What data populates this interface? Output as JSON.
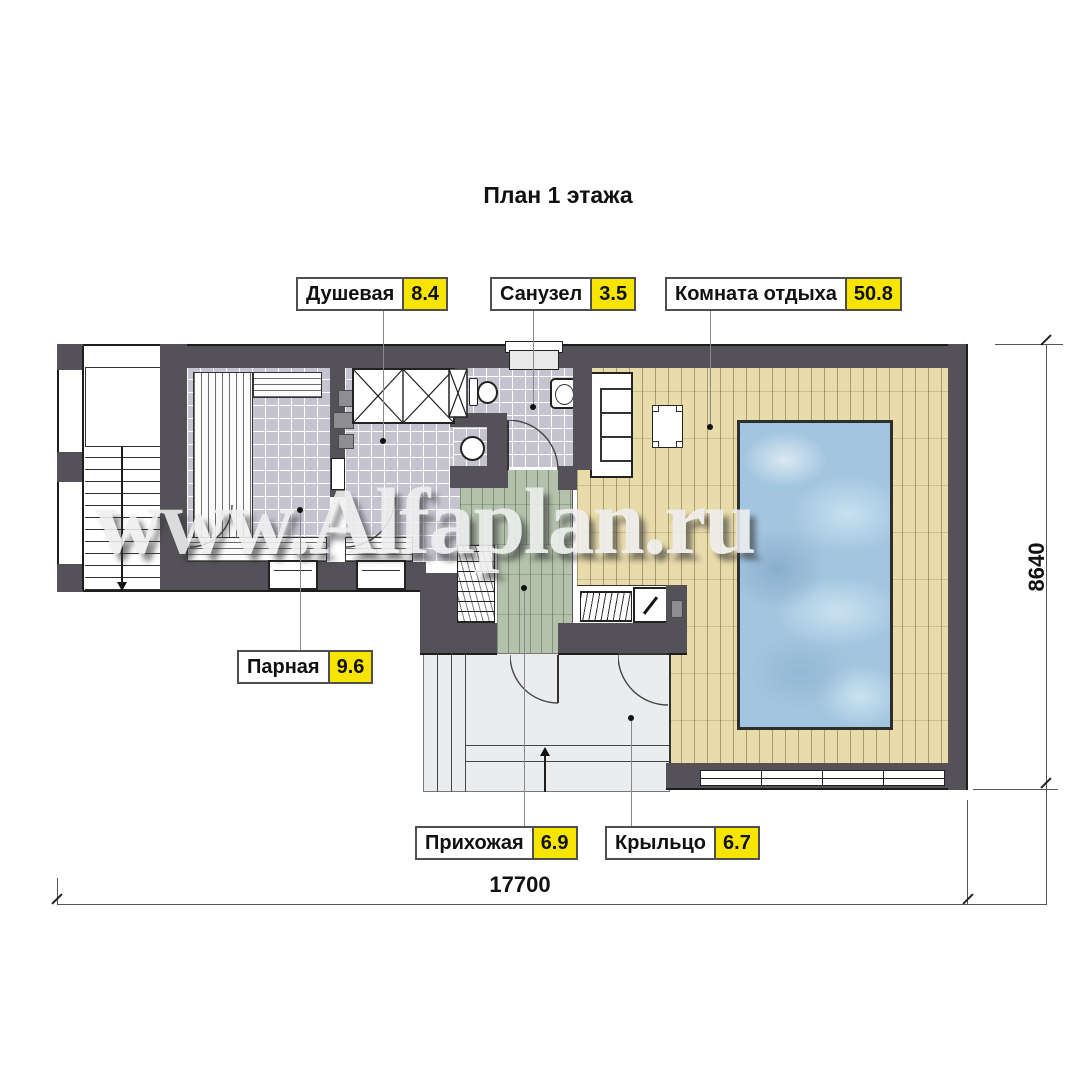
{
  "title": "План 1 этажа",
  "watermark": "www.Alfaplan.ru",
  "labels": {
    "shower": {
      "name": "Душевая",
      "area": "8.4"
    },
    "wc": {
      "name": "Санузел",
      "area": "3.5"
    },
    "lounge": {
      "name": "Комната отдыха",
      "area": "50.8"
    },
    "steam": {
      "name": "Парная",
      "area": "9.6"
    },
    "hall": {
      "name": "Прихожая",
      "area": "6.9"
    },
    "porch": {
      "name": "Крыльцо",
      "area": "6.7"
    }
  },
  "dimensions": {
    "width_mm": "17700",
    "height_mm": "8640"
  },
  "colors": {
    "wall": "#545158",
    "tile": "#c6c3d1",
    "wood": "#e9dcab",
    "hall_green": "#b3c2ac",
    "porch": "#eaecee",
    "water": "#a3c6e0",
    "label_area_bg": "#f7e500"
  }
}
